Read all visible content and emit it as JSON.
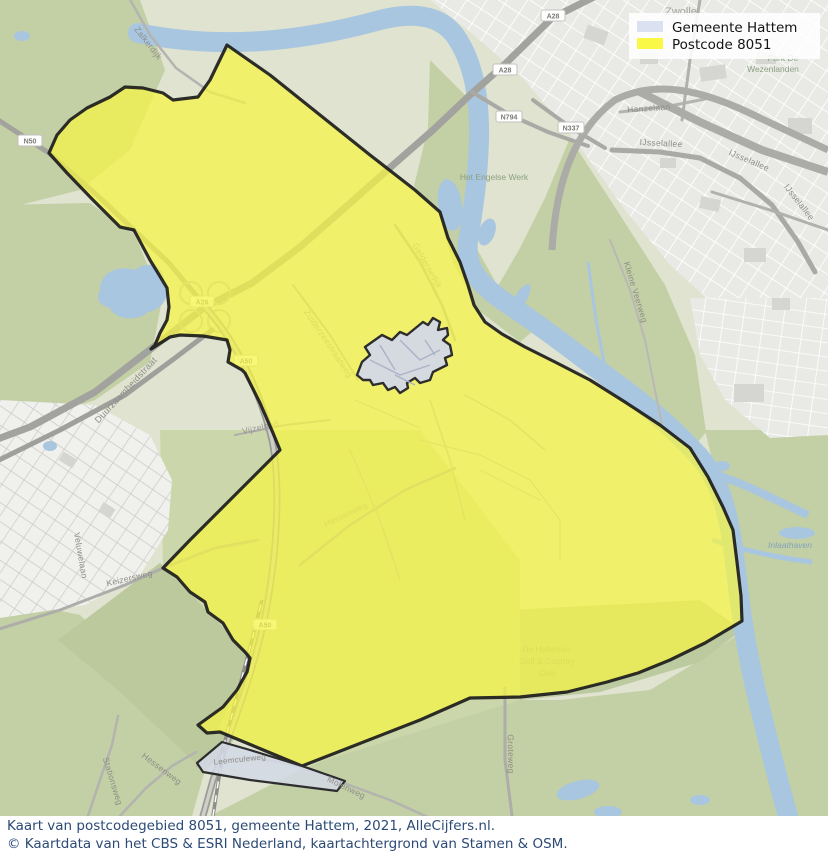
{
  "title": "Kaart van postcodegebied 8051, gemeente Hattem",
  "colors": {
    "gemeente_fill": "#dce1f1",
    "gemeente_area_fill": "#d3d9e6",
    "postcode_fill": "#f7f544",
    "boundary": "#1c1c1c",
    "water": "#a9c6e1",
    "forest": "#c3cfa4",
    "urban": "#e9e9e5",
    "caption_text": "#2c4a76"
  },
  "legend": {
    "items": [
      {
        "label": "Gemeente Hattem",
        "color": "#dce1f1"
      },
      {
        "label": "Postcode 8051",
        "color": "#f9f847"
      }
    ]
  },
  "caption": {
    "line1": "Kaart van postcodegebied 8051, gemeente Hattem, 2021, AlleCijfers.nl.",
    "line2": "© Kaartdata van het CBS & ESRI Nederland, kaartachtergrond van Stamen & OSM."
  },
  "map": {
    "city_label": "Zwolle",
    "shields": [
      {
        "label": "A28"
      },
      {
        "label": "A28"
      },
      {
        "label": "N794"
      },
      {
        "label": "N337"
      },
      {
        "label": "N50"
      },
      {
        "label": "A28"
      },
      {
        "label": "A50"
      },
      {
        "label": "A50"
      }
    ],
    "streets": [
      "Zalkerdijk",
      "Duurzaamheidstraat",
      "Veluwelaan",
      "Keizersweg",
      "Stationsweg",
      "Hessenweg",
      "Leemculeweg",
      "Molenweg",
      "Groteweg",
      "Hessenweg",
      "Geldersedijk",
      "Vijzelpad",
      "Zuiderzeestraatweg",
      "Kleine Veerweg",
      "Hanzelaan",
      "IJsselallee",
      "IJsselallee",
      "IJsselallee"
    ],
    "areas": {
      "park_line1": "Park De",
      "park_line2": "Wezenlanden",
      "engelse_werk": "Het Engelse Werk",
      "golf_line1": "De Hattemse",
      "golf_line2": "Golf & Country",
      "golf_line3": "Club",
      "inlaathaven": "Inlaathaven"
    }
  }
}
